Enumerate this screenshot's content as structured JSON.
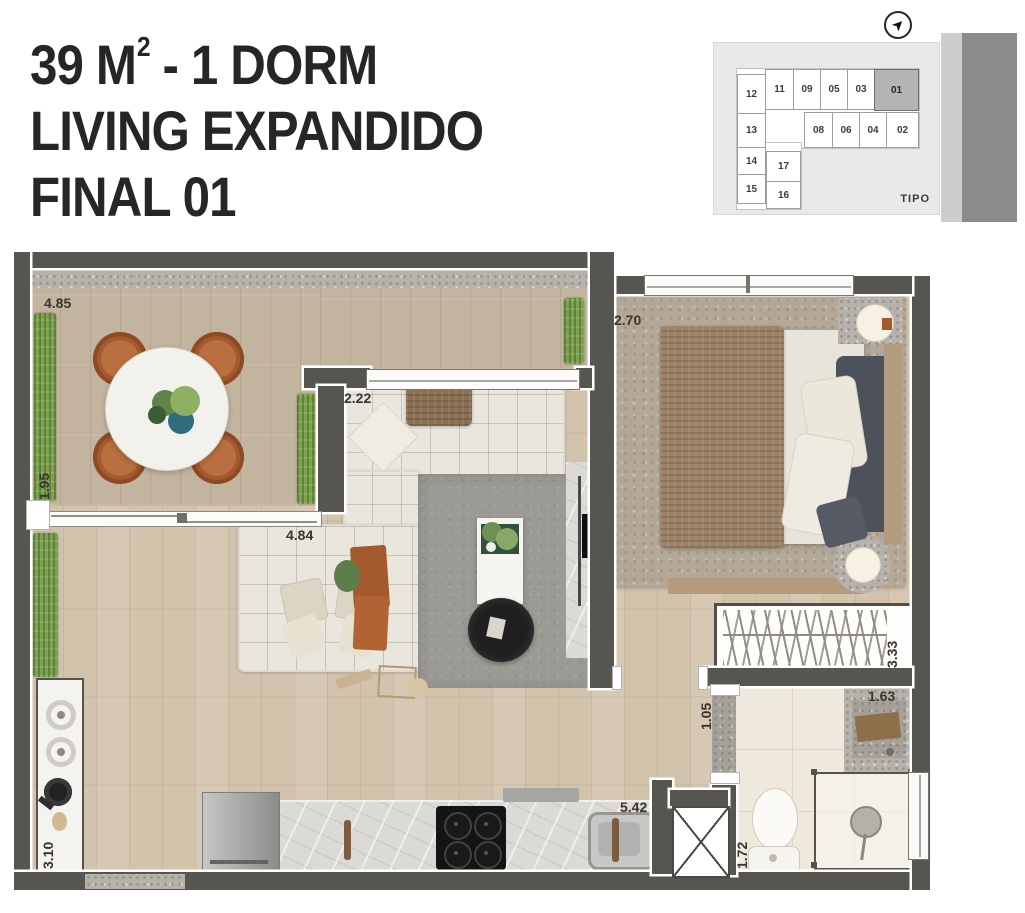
{
  "title": {
    "area_main": "39 M",
    "area_sup": "2",
    "area_rest": " - 1 DORM",
    "line2": "LIVING EXPANDIDO",
    "line3": "FINAL 01"
  },
  "keyplan": {
    "compass_glyph": "➤",
    "tipo_label": "TIPO",
    "highlighted_unit": "01",
    "rows": {
      "row1": [
        "12",
        "11",
        "09",
        "05",
        "03",
        "01"
      ],
      "row2": [
        "13",
        "08",
        "06",
        "04",
        "02"
      ],
      "row3": [
        "14",
        "17"
      ],
      "row4": [
        "15",
        "16"
      ]
    }
  },
  "dimensions": {
    "varanda_width": "4.85",
    "varanda_depth": "1.95",
    "living_window": "2.22",
    "bedroom_width": "2.70",
    "living_width": "4.84",
    "closet_depth": "3.33",
    "hall_width": "1.05",
    "bath_width": "1.63",
    "kitchen_length": "5.42",
    "bath_depth": "1.72",
    "counter_length": "3.10"
  },
  "colors": {
    "wall": "#57554f",
    "accent_rust": "#a5592e",
    "grass": "#7da24f",
    "keyplan_highlight": "#b4b4b2"
  }
}
